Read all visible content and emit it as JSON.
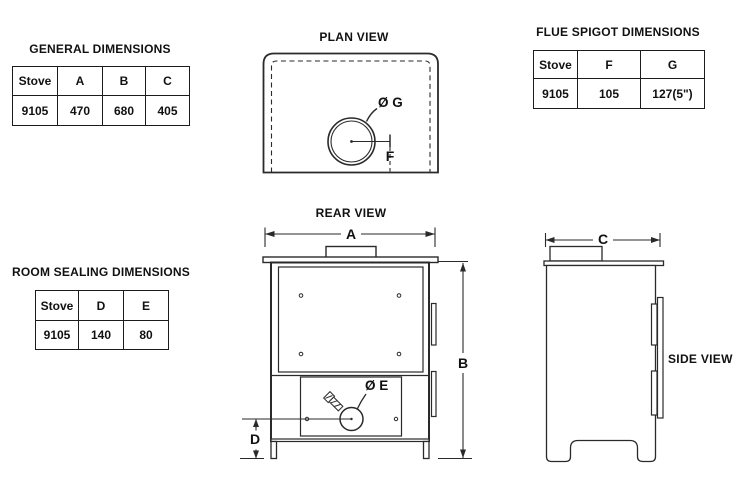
{
  "page": {
    "background": "#ffffff",
    "line_color": "#2a2a2a",
    "text_color": "#111111"
  },
  "tables": {
    "general": {
      "title": "GENERAL DIMENSIONS",
      "headers": [
        "Stove",
        "A",
        "B",
        "C"
      ],
      "rows": [
        [
          "9105",
          "470",
          "680",
          "405"
        ]
      ]
    },
    "flue_spigot": {
      "title": "FLUE SPIGOT DIMENSIONS",
      "headers": [
        "Stove",
        "F",
        "G"
      ],
      "rows": [
        [
          "9105",
          "105",
          "127(5\")"
        ]
      ]
    },
    "room_sealing": {
      "title": "ROOM SEALING DIMENSIONS",
      "headers": [
        "Stove",
        "D",
        "E"
      ],
      "rows": [
        [
          "9105",
          "140",
          "80"
        ]
      ]
    }
  },
  "views": {
    "plan": {
      "title": "PLAN VIEW",
      "labels": {
        "g": "Ø G",
        "f": "F"
      }
    },
    "rear": {
      "title": "REAR VIEW",
      "labels": {
        "a": "A",
        "b": "B",
        "d": "D",
        "e": "Ø E"
      }
    },
    "side": {
      "title": "SIDE VIEW",
      "labels": {
        "c": "C"
      }
    }
  }
}
